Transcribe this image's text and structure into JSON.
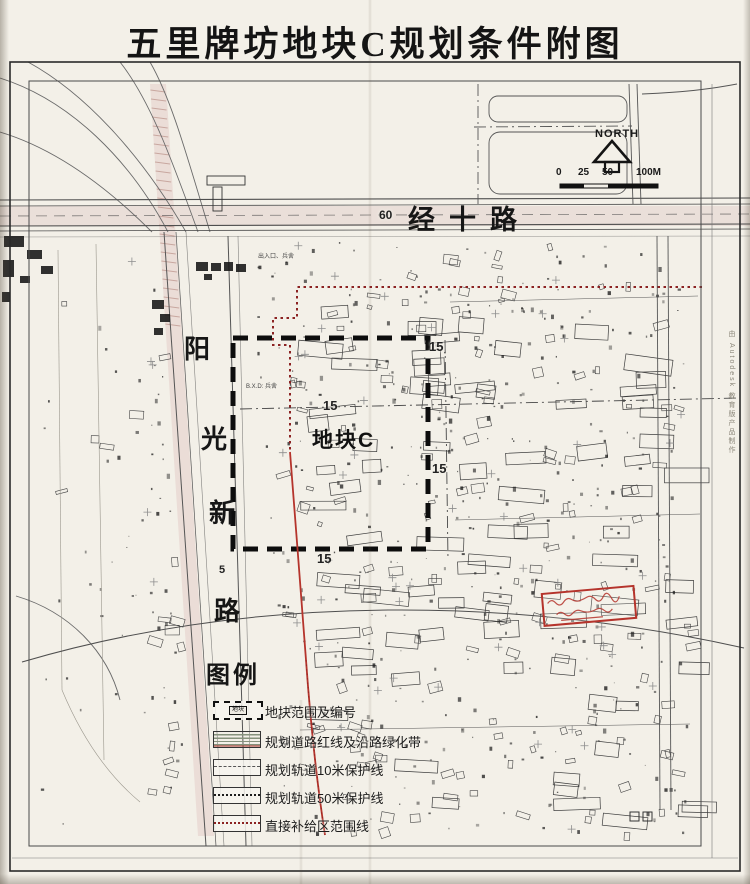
{
  "title": "五里牌坊地块C规划条件附图",
  "roads": {
    "jingshi_label": "经十路",
    "jingshi_width": "60",
    "yangguang_chars": [
      "阳",
      "光",
      "新",
      "路"
    ]
  },
  "plot": {
    "label": "地块C"
  },
  "dims": {
    "d15_top": "15",
    "d15_ne": "15",
    "d15_east": "15",
    "d15_south": "15",
    "d5_west": "5"
  },
  "notes": {
    "entrance": "出入口、兵舍",
    "barracks": "B.X.D: 兵舍"
  },
  "compass": {
    "north_label": "NORTH",
    "scale_ticks": [
      "0",
      "25",
      "50",
      "100M"
    ]
  },
  "legend": {
    "title": "图例",
    "plot_symbol_text": "地块",
    "items": [
      "地块范围及编号",
      "规划道路红线及沿路绿化带",
      "规划轨道10米保护线",
      "规划轨道50米保护线",
      "直接补给区范围线"
    ]
  },
  "watermark": "由 Autodesk 教育版产品制作",
  "colors": {
    "paper": "#f3f0e8",
    "ink": "#1f1f1f",
    "red_dotted": "#8b2222",
    "red_solid": "#b5342c",
    "pink_band": "#e3cdc8",
    "road_fill": "#e7dbd4"
  }
}
